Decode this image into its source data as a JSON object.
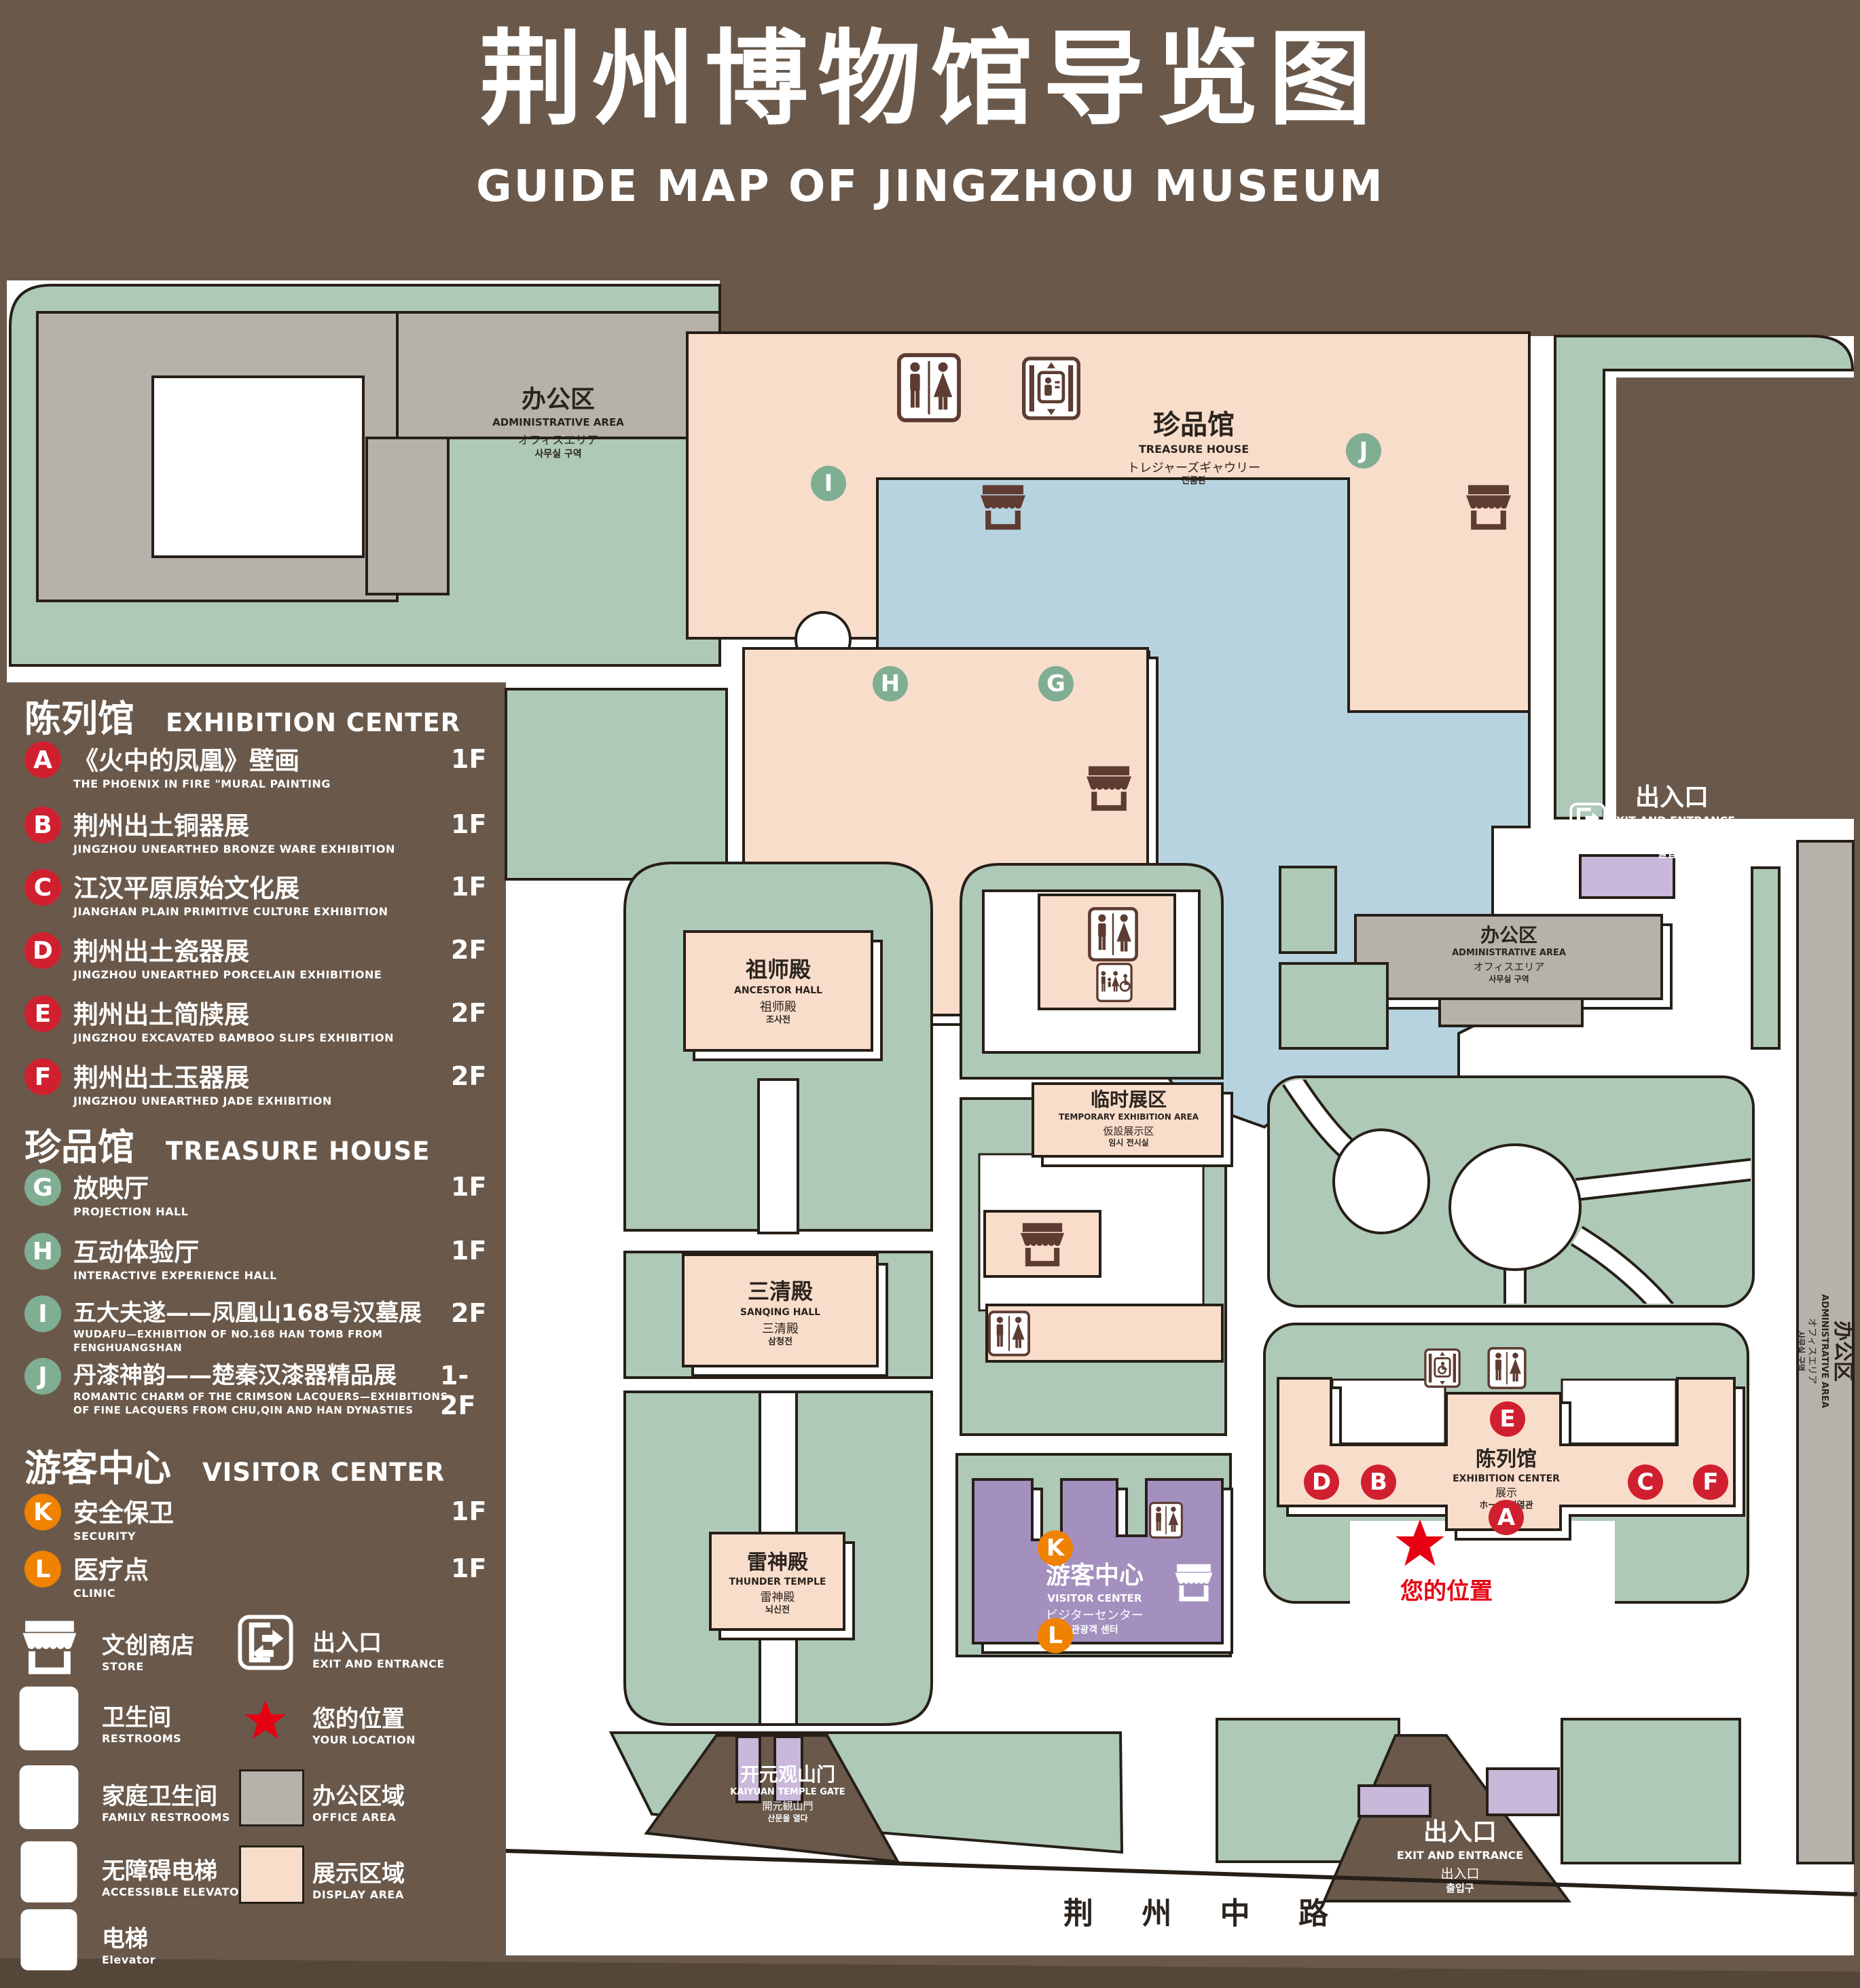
{
  "title": {
    "zh": "荆州博物馆导览图",
    "en": "GUIDE MAP OF JINGZHOU MUSEUM"
  },
  "colors": {
    "background": "#6a594b",
    "display_area": "#f9ddcb",
    "office_area": "#b7b1ac",
    "lawn": "#aec9b7",
    "lake": "#b7d3e0",
    "visitor_center": "#a390bf",
    "gate_purple": "#c9b8da",
    "marker_red": "#d0202f",
    "marker_green": "#7fae93",
    "marker_orange": "#ef8200",
    "location_red": "#e60012",
    "outline": "#261f18"
  },
  "legend": {
    "sections": [
      {
        "zh": "陈列馆",
        "en": "EXHIBITION CENTER"
      },
      {
        "zh": "珍品馆",
        "en": "TREASURE HOUSE"
      },
      {
        "zh": "游客中心",
        "en": "VISITOR CENTER"
      }
    ],
    "items": [
      {
        "id": "A",
        "zh": "《火中的凤凰》壁画",
        "en": "THE PHOENIX IN FIRE \"MURAL PAINTING",
        "floor": "1F"
      },
      {
        "id": "B",
        "zh": "荆州出土铜器展",
        "en": "JINGZHOU UNEARTHED BRONZE WARE EXHIBITION",
        "floor": "1F"
      },
      {
        "id": "C",
        "zh": "江汉平原原始文化展",
        "en": "JIANGHAN PLAIN PRIMITIVE CULTURE EXHIBITION",
        "floor": "1F"
      },
      {
        "id": "D",
        "zh": "荆州出土瓷器展",
        "en": "JINGZHOU UNEARTHED PORCELAIN EXHIBITIONE",
        "floor": "2F"
      },
      {
        "id": "E",
        "zh": "荆州出土简牍展",
        "en": "JINGZHOU EXCAVATED BAMBOO SLIPS EXHIBITION",
        "floor": "2F"
      },
      {
        "id": "F",
        "zh": "荆州出土玉器展",
        "en": "JINGZHOU UNEARTHED JADE EXHIBITION",
        "floor": "2F"
      },
      {
        "id": "G",
        "zh": "放映厅",
        "en": "PROJECTION HALL",
        "floor": "1F"
      },
      {
        "id": "H",
        "zh": "互动体验厅",
        "en": "INTERACTIVE EXPERIENCE HALL",
        "floor": "1F"
      },
      {
        "id": "I",
        "zh": "五大夫遂——凤凰山168号汉墓展",
        "en": "WUDAFU—EXHIBITION OF NO.168 HAN TOMB FROM FENGHUANGSHAN",
        "floor": "2F"
      },
      {
        "id": "J",
        "zh": "丹漆神韵——楚秦汉漆器精品展",
        "en": "ROMANTIC CHARM OF THE CRIMSON LACQUERS—EXHIBITIONS OF FINE LACQUERS FROM CHU,QIN AND HAN DYNASTIES",
        "floor": "1-2F"
      },
      {
        "id": "K",
        "zh": "安全保卫",
        "en": "SECURITY",
        "floor": "1F"
      },
      {
        "id": "L",
        "zh": "医疗点",
        "en": "CLINIC",
        "floor": "1F"
      }
    ],
    "facilities": [
      {
        "icon": "store-icon",
        "zh": "文创商店",
        "en": "STORE"
      },
      {
        "icon": "restrooms-icon",
        "zh": "卫生间",
        "en": "RESTROOMS"
      },
      {
        "icon": "family-restrooms-icon",
        "zh": "家庭卫生间",
        "en": "FAMILY RESTROOMS"
      },
      {
        "icon": "accessible-elevator-icon",
        "zh": "无障碍电梯",
        "en": "ACCESSIBLE ELEVATOR"
      },
      {
        "icon": "elevator-icon",
        "zh": "电梯",
        "en": "Elevator"
      }
    ],
    "symbols": [
      {
        "icon": "exit-icon",
        "zh": "出入口",
        "en": "EXIT AND ENTRANCE"
      },
      {
        "icon": "location-star",
        "zh": "您的位置",
        "en": "YOUR LOCATION"
      },
      {
        "icon": "office-swatch",
        "zh": "办公区域",
        "en": "OFFICE AREA"
      },
      {
        "icon": "display-swatch",
        "zh": "展示区域",
        "en": "DISPLAY AREA"
      }
    ]
  },
  "map": {
    "buildings": {
      "admin": {
        "zh": "办公区",
        "en": "ADMINISTRATIVE AREA",
        "ja": "オフィスエリア",
        "ko": "사무실 구역"
      },
      "treasure_house": {
        "zh": "珍品馆",
        "en": "TREASURE HOUSE",
        "ja": "トレジャーズギャウリー",
        "ko": "진품관"
      },
      "ancestor_hall": {
        "zh": "祖师殿",
        "en": "ANCESTOR HALL",
        "ja": "祖师殿",
        "ko": "조사전"
      },
      "sanqing_hall": {
        "zh": "三清殿",
        "en": "SANQING HALL",
        "ja": "三清殿",
        "ko": "삼청전"
      },
      "thunder_temple": {
        "zh": "雷神殿",
        "en": "THUNDER TEMPLE",
        "ja": "雷神殿",
        "ko": "뇌신전"
      },
      "temporary_exhibition": {
        "zh": "临时展区",
        "en": "TEMPORARY EXHIBITION AREA",
        "ja": "仮設展示区",
        "ko": "임시 전시실"
      },
      "exhibition_center": {
        "zh": "陈列馆",
        "en": "EXHIBITION CENTER",
        "l3": "展示",
        "l4": "ホール 진열관"
      },
      "visitor_center": {
        "zh": "游客中心",
        "en": "VISITOR CENTER",
        "ja": "ビジターセンター",
        "ko": "관광객 센터"
      },
      "kaiyuan_gate": {
        "zh": "开元观山门",
        "en": "KAIYUAN TEMPLE GATE",
        "ja": "開元観山門",
        "ko": "산문을 열다"
      }
    },
    "exit": {
      "zh": "出入口",
      "en": "EXIT AND ENTRANCE",
      "ja": "出入口",
      "ko": "출입구"
    },
    "your_location": "您的位置",
    "road": "荆 州 中 路"
  }
}
